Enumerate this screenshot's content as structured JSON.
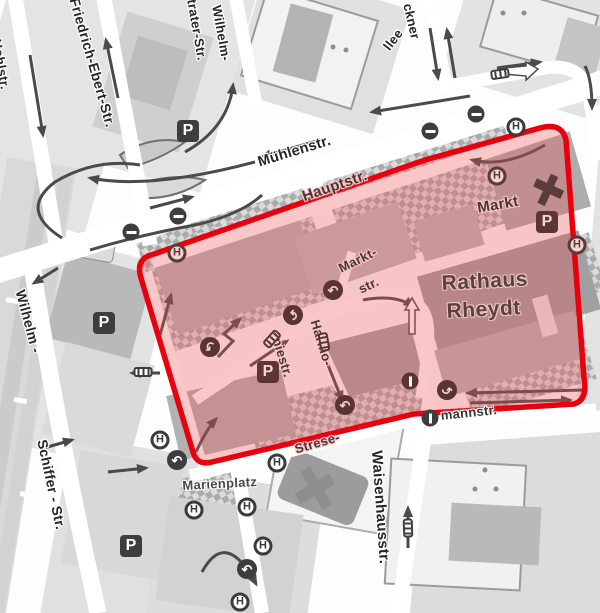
{
  "zone": {
    "border_color": "#e8000f",
    "fill_color": "rgba(237,80,80,0.32)",
    "description_labels_inside": [
      "Hauptstr.",
      "Markt- str.",
      "Rathaus Rheydt",
      "Markt",
      "Harmo- niestr.",
      "Strese-"
    ]
  },
  "streets": {
    "hohlstr": "Hohlstr.",
    "friedrich_ebert": "Friedrich-Ebert-Str.",
    "wilhelm_strater_1": "Wilhelm-",
    "wilhelm_strater_2": "trater-Str.",
    "bruckner_1": "ckner",
    "bruckner_2": "llee",
    "muehlenstr": "Mühlenstr.",
    "hauptstr": "Hauptstr.",
    "marktstr_1": "Markt-",
    "marktstr_2": "str.",
    "harmoniestr_1": "Harmo-",
    "harmoniestr_2": "niestr.",
    "stresemannstr_1": "Strese-",
    "stresemannstr_2": "mannstr.",
    "wilhelm_schiffer_1": "Wilhelm -",
    "wilhelm_schiffer_2": "Schiffer -  Str.",
    "waisenhausstr": "Waisenhausstr."
  },
  "places": {
    "rathaus_1": "Rathaus",
    "rathaus_2": "Rheydt",
    "markt": "Markt",
    "marienplatz": "Marienplatz"
  },
  "icons": {
    "bus_stop_letter": "H",
    "parking_letter": "P",
    "turn_arrow_glyph": "↶",
    "no_entry": "css-circle-horizontal-bar",
    "one_way": "css-circle-vertical-bar",
    "bus": "css-bus-pictogram",
    "church_cross": "css-cross"
  }
}
